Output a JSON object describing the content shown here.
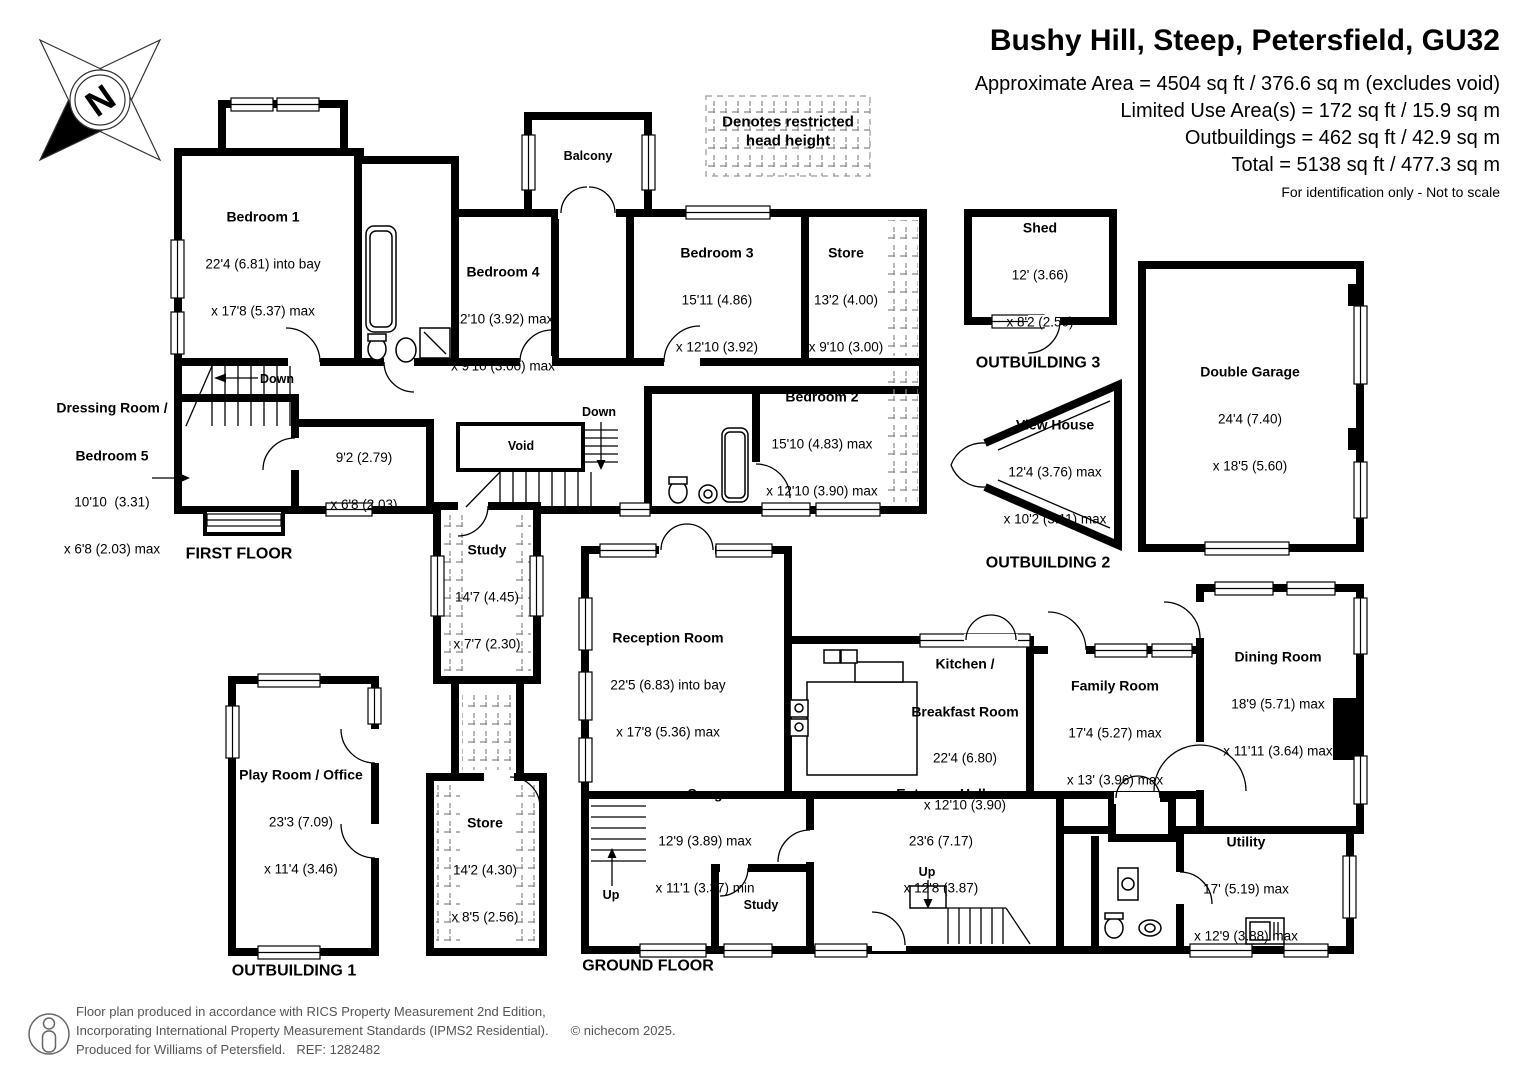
{
  "header": {
    "title": "Bushy Hill, Steep, Petersfield, GU32",
    "line1": "Approximate Area = 4504 sq ft / 376.6 sq m (excludes void)",
    "line2": "Limited Use Area(s) = 172 sq ft / 15.9 sq m",
    "line3": "Outbuildings = 462 sq ft / 42.9 sq m",
    "line4": "Total = 5138 sq ft / 477.3 sq m",
    "disclaimer": "For identification only - Not to scale"
  },
  "legend": {
    "line1": "Denotes restricted",
    "line2": "head height"
  },
  "compass": {
    "north": "N"
  },
  "colors": {
    "wall": "#000000",
    "hatch": "#888888",
    "footer_text": "#555555"
  },
  "first_floor": {
    "label": "FIRST FLOOR",
    "down": "Down",
    "balcony": "Balcony",
    "void": "Void",
    "bedroom1": {
      "name": "Bedroom 1",
      "d1": "22'4 (6.81) into bay",
      "d2": "x 17'8 (5.37) max"
    },
    "bedroom4": {
      "name": "Bedroom 4",
      "d1": "12'10 (3.92) max",
      "d2": "x 9'10 (3.00) max"
    },
    "bedroom3": {
      "name": "Bedroom 3",
      "d1": "15'11 (4.86)",
      "d2": "x 12'10 (3.92)"
    },
    "store": {
      "name": "Store",
      "d1": "13'2 (4.00)",
      "d2": "x 9'10 (3.00)"
    },
    "bedroom2": {
      "name": "Bedroom 2",
      "d1": "15'10 (4.83) max",
      "d2": "x 12'10 (3.90) max"
    },
    "dressing": {
      "name1": "Dressing Room /",
      "name2": "Bedroom 5",
      "d1": "10'10  (3.31)",
      "d2": "x 6'8 (2.03) max"
    },
    "inner_room": {
      "d1": "9'2 (2.79)",
      "d2": "x 6'8 (2.03)"
    },
    "study": {
      "name": "Study",
      "d1": "14'7 (4.45)",
      "d2": "x 7'7 (2.30)"
    }
  },
  "ground_floor": {
    "label": "GROUND FLOOR",
    "up": "Up",
    "study": "Study",
    "reception": {
      "name": "Reception Room",
      "d1": "22'5 (6.83) into bay",
      "d2": "x 17'8 (5.36) max"
    },
    "kitchen": {
      "name1": "Kitchen /",
      "name2": "Breakfast Room",
      "d1": "22'4 (6.80)",
      "d2": "x 12'10 (3.90)"
    },
    "family": {
      "name": "Family Room",
      "d1": "17'4 (5.27) max",
      "d2": "x 13' (3.96) max"
    },
    "dining": {
      "name": "Dining Room",
      "d1": "18'9 (5.71) max",
      "d2": "x 11'11 (3.64) max"
    },
    "snug": {
      "name": "Snug",
      "d1": "12'9 (3.89) max",
      "d2": "x 11'1 (3.37) min"
    },
    "entrance": {
      "name": "Entrance Hall",
      "d1": "23'6 (7.17)",
      "d2": "x 12'8 (3.87)"
    },
    "utility": {
      "name": "Utility",
      "d1": "17' (5.19) max",
      "d2": "x 12'9 (3.88) max"
    }
  },
  "outbuildings": {
    "ob1": {
      "label": "OUTBUILDING 1",
      "name": "Play Room / Office",
      "d1": "23'3 (7.09)",
      "d2": "x 11'4 (3.46)"
    },
    "store": {
      "name": "Store",
      "d1": "14'2 (4.30)",
      "d2": "x 8'5 (2.56)"
    },
    "ob2": {
      "label": "OUTBUILDING 2",
      "name": "View House",
      "d1": "12'4 (3.76) max",
      "d2": "x 10'2 (3.11) max"
    },
    "ob3": {
      "label": "OUTBUILDING 3",
      "name": "Shed",
      "d1": "12' (3.66)",
      "d2": "x 8'2 (2.50)"
    },
    "garage": {
      "name": "Double Garage",
      "d1": "24'4 (7.40)",
      "d2": "x 18'5 (5.60)"
    }
  },
  "footer": {
    "line1": "Floor plan produced in accordance with RICS Property Measurement 2nd Edition,",
    "line2": "Incorporating International Property Measurement Standards (IPMS2 Residential).",
    "line3": "Produced for Williams of Petersfield.   REF: 1282482",
    "copyright": "© nichecom 2025."
  }
}
